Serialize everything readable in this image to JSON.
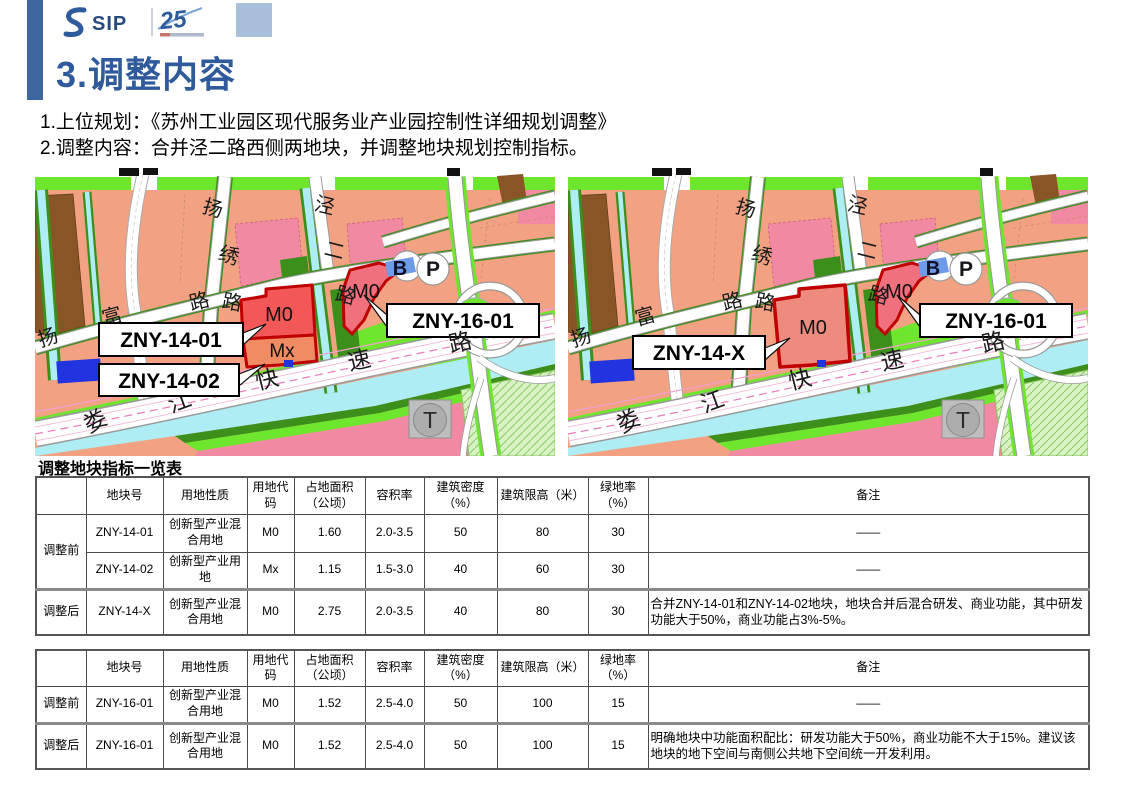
{
  "slide": {
    "title": "3.调整内容",
    "accent_color": "#2F5B9C",
    "logo": {
      "brand": "SIP",
      "badge": "25"
    },
    "intro1": "1.上位规划：《苏州工业园区现代服务业产业园控制性详细规划调整》",
    "intro2": "2.调整内容：合并泾二路西侧两地块，并调整地块规划控制指标。"
  },
  "maps": {
    "roads": {
      "yangxiu": "扬绣路",
      "jinger": "泾二路",
      "yangfu": "扬富路",
      "loujiang": "娄江快速路"
    },
    "markers": {
      "b": "B",
      "p": "P",
      "t": "T"
    },
    "codes": {
      "m0": "M0",
      "mx": "Mx"
    },
    "labels": {
      "zny16": "ZNY-16-01"
    },
    "left": {
      "label_14_01": "ZNY-14-01",
      "label_14_02": "ZNY-14-02"
    },
    "right": {
      "label_14_x": "ZNY-14-X"
    },
    "colors": {
      "parcel_red": "#F25858",
      "parcel_mx": "#F08B63",
      "parcel_16": "#F0707E",
      "parcel_merged": "#EF8B7E",
      "parcel_outline": "#C00000",
      "salmon": "#F2A183",
      "pink": "#F289A3",
      "bright_green": "#6FE62E",
      "dark_green": "#3D8F1C",
      "water_cyan": "#AEEDF4",
      "brown": "#8A5526",
      "royal_blue": "#2233E0",
      "b_parcel_blue": "#6E9BE8"
    }
  },
  "table_caption": "调整地块指标一览表",
  "tables": [
    {
      "headers": [
        "",
        "地块号",
        "用地性质",
        "用地代码",
        "占地面积（公顷）",
        "容积率",
        "建筑密度（%）",
        "建筑限高（米）",
        "绿地率（%）",
        "备注"
      ],
      "rows": [
        {
          "group": "调整前",
          "cells": [
            "ZNY-14-01",
            "创新型产业混合用地",
            "M0",
            "1.60",
            "2.0-3.5",
            "50",
            "80",
            "30",
            "——"
          ]
        },
        {
          "cells": [
            "ZNY-14-02",
            "创新型产业用地",
            "Mx",
            "1.15",
            "1.5-3.0",
            "40",
            "60",
            "30",
            "——"
          ]
        },
        {
          "group": "调整后",
          "cells": [
            "ZNY-14-X",
            "创新型产业混合用地",
            "M0",
            "2.75",
            "2.0-3.5",
            "40",
            "80",
            "30",
            "合并ZNY-14-01和ZNY-14-02地块，地块合并后混合研发、商业功能，其中研发功能大于50%，商业功能占3%-5%。"
          ]
        }
      ]
    },
    {
      "headers": [
        "",
        "地块号",
        "用地性质",
        "用地代码",
        "占地面积（公顷）",
        "容积率",
        "建筑密度（%）",
        "建筑限高（米）",
        "绿地率（%）",
        "备注"
      ],
      "rows": [
        {
          "group": "调整前",
          "cells": [
            "ZNY-16-01",
            "创新型产业混合用地",
            "M0",
            "1.52",
            "2.5-4.0",
            "50",
            "100",
            "15",
            "——"
          ]
        },
        {
          "group": "调整后",
          "cells": [
            "ZNY-16-01",
            "创新型产业混合用地",
            "M0",
            "1.52",
            "2.5-4.0",
            "50",
            "100",
            "15",
            "明确地块中功能面积配比：研发功能大于50%，商业功能不大于15%。建议该地块的地下空间与南侧公共地下空间统一开发利用。"
          ]
        }
      ]
    }
  ]
}
